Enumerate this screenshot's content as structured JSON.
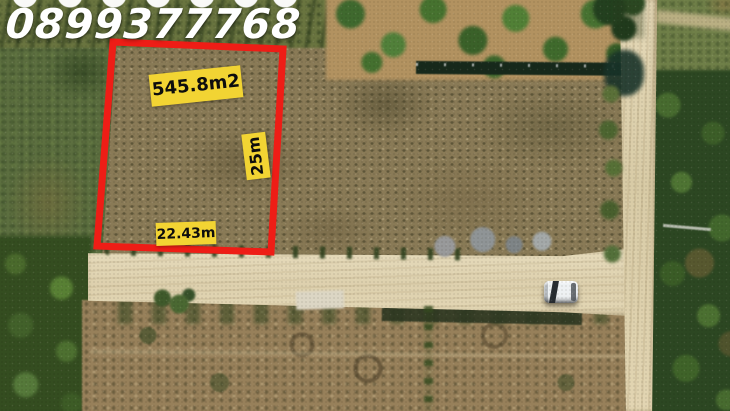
{
  "annotations": {
    "phone_number": "0899377768",
    "area_label": "545.8m2",
    "height_label": "25m",
    "width_label": "22.43m"
  },
  "colors": {
    "plot_outline_red": "#ee1d16",
    "label_background_yellow": "#f2d433",
    "label_text_black": "#0d0d0d",
    "phone_text_white": "#ffffff"
  }
}
